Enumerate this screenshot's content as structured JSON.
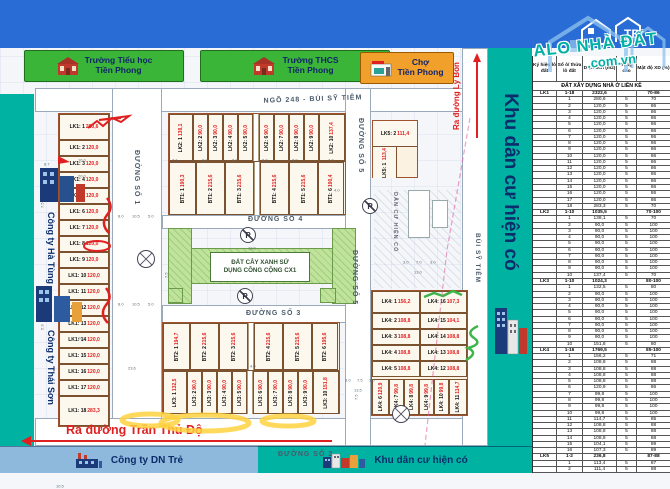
{
  "title": "KHU DÂN CƯ PHỐ BÙI SỸ TIÊM",
  "distributor": {
    "label": "ĐƠN VỊ PHÂN PHỐI",
    "logo_text": "THAI BINH LAND"
  },
  "watermark": {
    "line1": "ALO NHÀ ĐẤT",
    "line2": ".com.vn"
  },
  "colors": {
    "header_blue": "#2a6cd5",
    "teal": "#00b2a2",
    "lot_value_red": "#e02020",
    "green_area": "#bfe39b",
    "landmark_green": "#3bb537",
    "landmark_orange": "#f2a02c",
    "annotation_yellow": "#ffd23f"
  },
  "landmarks": {
    "school1_line1": "Trường Tiểu học",
    "school1_line2": "Tiền Phong",
    "school2_line1": "Trường THCS",
    "school2_line2": "Tiền Phong",
    "market_line1": "Chợ",
    "market_line2": "Tiền Phong"
  },
  "companies": {
    "c1": "Công ty Hà Tùng",
    "c2": "Công ty Thái Sơn",
    "c3": "Công ty DN Trẻ"
  },
  "sidebar": {
    "label": "Khu dân cư hiện có"
  },
  "bottom": {
    "teal_label": "Khu dân cư hiện có"
  },
  "exits": {
    "lybon": "Ra đường Lý Bôn",
    "tranthudo": "Ra đường Trần Thủ Độ"
  },
  "streets": {
    "ngo248": "NGÕ 248 - BÙI SỸ TIÊM",
    "d1": "ĐƯỜNG SỐ 1",
    "d2": "ĐƯỜNG SỐ 2",
    "d3": "ĐƯỜNG SỐ 3",
    "d4": "ĐƯỜNG SỐ 4",
    "d5": "ĐƯỜNG SỐ 5",
    "bst": "BÙI SỸ TIÊM",
    "existing": "DÂN CƯ HIỆN CÓ"
  },
  "green": {
    "cx1_line1": "ĐẤT CÂY XANH SỬ",
    "cx1_line2": "DỤNG CÔNG CỘNG CX1",
    "parking": "P"
  },
  "map": {
    "lk1_lots": [
      {
        "c": "LK1: 1",
        "v": "280,6",
        "h": 26
      },
      {
        "c": "LK1: 2",
        "v": "120,0",
        "h": 16
      },
      {
        "c": "LK1: 3",
        "v": "120,0",
        "h": 16
      },
      {
        "c": "LK1: 4",
        "v": "120,0",
        "h": 16
      },
      {
        "c": "LK1: 5",
        "v": "120,0",
        "h": 16
      },
      {
        "c": "LK1: 6",
        "v": "120,0",
        "h": 16
      },
      {
        "c": "LK1: 7",
        "v": "120,0",
        "h": 16
      },
      {
        "c": "LK1: 8",
        "v": "120,0",
        "h": 16
      },
      {
        "c": "LK1: 9",
        "v": "120,0",
        "h": 16
      },
      {
        "c": "LK1: 10",
        "v": "120,0",
        "h": 16
      },
      {
        "c": "LK1: 11",
        "v": "120,0",
        "h": 16
      },
      {
        "c": "LK1: 12",
        "v": "120,0",
        "h": 16
      },
      {
        "c": "LK1: 13",
        "v": "120,0",
        "h": 16
      },
      {
        "c": "LK1: 14",
        "v": "120,0",
        "h": 16
      },
      {
        "c": "LK1: 15",
        "v": "120,0",
        "h": 16
      },
      {
        "c": "LK1: 16",
        "v": "120,0",
        "h": 16
      },
      {
        "c": "LK1: 17",
        "v": "120,0",
        "h": 16
      },
      {
        "c": "LK1: 18",
        "v": "283,3",
        "h": 30
      }
    ],
    "lk2_row": [
      {
        "c": "LK2: 1",
        "v": "138,1",
        "w": 24
      },
      {
        "c": "LK2: 2",
        "v": "90,0",
        "w": 15
      },
      {
        "c": "LK2: 3",
        "v": "90,0",
        "w": 15
      },
      {
        "c": "LK2: 4",
        "v": "90,0",
        "w": 15
      },
      {
        "c": "LK2: 5",
        "v": "90,0",
        "w": 15
      },
      {
        "gap": true,
        "w": 6
      },
      {
        "c": "LK2: 6",
        "v": "90,0",
        "w": 15
      },
      {
        "c": "LK2: 7",
        "v": "90,0",
        "w": 15
      },
      {
        "c": "LK2: 8",
        "v": "90,0",
        "w": 15
      },
      {
        "c": "LK2: 9",
        "v": "90,0",
        "w": 15
      },
      {
        "c": "LK2: 10",
        "v": "137,4",
        "w": 26
      }
    ],
    "bt1_row": [
      {
        "c": "BT1: 1",
        "v": "190,3",
        "w": 27
      },
      {
        "c": "BT1: 2",
        "v": "215,6",
        "w": 29
      },
      {
        "c": "BT1: 3",
        "v": "215,6",
        "w": 29
      },
      {
        "gap": true,
        "w": 6
      },
      {
        "c": "BT1: 4",
        "v": "215,6",
        "w": 29
      },
      {
        "c": "BT1: 5",
        "v": "215,6",
        "w": 29
      },
      {
        "c": "BT1: 6",
        "v": "190,4",
        "w": 26
      }
    ],
    "bt2_row": [
      {
        "c": "BT2: 1",
        "v": "194,7",
        "w": 27
      },
      {
        "c": "BT2: 2",
        "v": "215,6",
        "w": 29
      },
      {
        "c": "BT2: 3",
        "v": "215,6",
        "w": 29
      },
      {
        "gap": true,
        "w": 6
      },
      {
        "c": "BT2: 4",
        "v": "215,6",
        "w": 29
      },
      {
        "c": "BT2: 5",
        "v": "215,6",
        "w": 29
      },
      {
        "c": "BT2: 6",
        "v": "195,6",
        "w": 26
      }
    ],
    "lk3_row": [
      {
        "c": "LK3: 1",
        "v": "132,5",
        "w": 24
      },
      {
        "c": "LK3: 2",
        "v": "90,0",
        "w": 15
      },
      {
        "c": "LK3: 3",
        "v": "90,0",
        "w": 15
      },
      {
        "c": "LK3: 4",
        "v": "90,0",
        "w": 15
      },
      {
        "c": "LK3: 5",
        "v": "90,0",
        "w": 15
      },
      {
        "gap": true,
        "w": 6
      },
      {
        "c": "LK3: 6",
        "v": "90,0",
        "w": 15
      },
      {
        "c": "LK3: 7",
        "v": "90,0",
        "w": 15
      },
      {
        "c": "LK3: 8",
        "v": "90,0",
        "w": 15
      },
      {
        "c": "LK3: 9",
        "v": "90,0",
        "w": 15
      },
      {
        "c": "LK3: 10",
        "v": "151,8",
        "w": 26
      }
    ],
    "lk4_left": [
      {
        "c": "LK4: 1",
        "v": "156,2",
        "h": 22
      },
      {
        "c": "LK4: 2",
        "v": "108,8",
        "h": 16
      },
      {
        "c": "LK4: 3",
        "v": "108,8",
        "h": 16
      },
      {
        "c": "LK4: 4",
        "v": "108,8",
        "h": 16
      },
      {
        "c": "LK4: 5",
        "v": "108,8",
        "h": 16
      }
    ],
    "lk4_right": [
      {
        "c": "LK4: 16",
        "v": "107,3",
        "h": 22
      },
      {
        "c": "LK4: 15",
        "v": "104,1",
        "h": 16
      },
      {
        "c": "LK4: 14",
        "v": "108,8",
        "h": 16
      },
      {
        "c": "LK4: 13",
        "v": "108,8",
        "h": 16
      },
      {
        "c": "LK4: 12",
        "v": "108,8",
        "h": 16
      }
    ],
    "lk4_bottom": [
      {
        "c": "LK4: 6",
        "v": "120,9",
        "w": 17
      },
      {
        "c": "LK4: 7",
        "v": "99,8",
        "w": 15
      },
      {
        "c": "LK4: 8",
        "v": "99,8",
        "w": 15
      },
      {
        "c": "LK4: 9",
        "v": "99,8",
        "w": 15
      },
      {
        "c": "LK4: 10",
        "v": "99,8",
        "w": 15
      },
      {
        "c": "LK4: 11",
        "v": "114,7",
        "w": 18
      }
    ],
    "lk5_top": {
      "c": "LK5: 2",
      "v": "111,4"
    },
    "lk5_bottom": {
      "c": "LK5: 1",
      "v": "113,4"
    },
    "dimensions": [
      {
        "t": "8.7",
        "x": 44,
        "y": 114
      },
      {
        "t": "16.0",
        "x": 78,
        "y": 110
      },
      {
        "t": "20.0",
        "x": 78,
        "y": 126
      },
      {
        "t": "7.5",
        "x": 40,
        "y": 160,
        "r": 1
      },
      {
        "t": "5.3",
        "x": 40,
        "y": 282,
        "r": 1
      },
      {
        "t": "20.0",
        "x": 78,
        "y": 288
      },
      {
        "t": "16.0",
        "x": 76,
        "y": 418
      },
      {
        "t": "5.3",
        "x": 50,
        "y": 416
      },
      {
        "t": "8.0",
        "x": 118,
        "y": 166
      },
      {
        "t": "10.5",
        "x": 132,
        "y": 166
      },
      {
        "t": "5.0",
        "x": 148,
        "y": 166
      },
      {
        "t": "8.0",
        "x": 118,
        "y": 254
      },
      {
        "t": "10.5",
        "x": 132,
        "y": 254
      },
      {
        "t": "5.0",
        "x": 148,
        "y": 254
      },
      {
        "t": "23.6",
        "x": 128,
        "y": 318
      },
      {
        "t": "10.5",
        "x": 56,
        "y": 436
      },
      {
        "t": "7.1",
        "x": 172,
        "y": 110
      },
      {
        "t": "8.0",
        "x": 202,
        "y": 110
      },
      {
        "t": "8.0",
        "x": 232,
        "y": 110
      },
      {
        "t": "8.0",
        "x": 262,
        "y": 110
      },
      {
        "t": "8.0",
        "x": 292,
        "y": 110
      },
      {
        "t": "7.0",
        "x": 328,
        "y": 110
      },
      {
        "t": "4.0",
        "x": 334,
        "y": 140
      },
      {
        "t": "12.0",
        "x": 248,
        "y": 198
      },
      {
        "t": "4.0",
        "x": 250,
        "y": 316
      },
      {
        "t": "3.0",
        "x": 403,
        "y": 212
      },
      {
        "t": "7.0",
        "x": 416,
        "y": 212
      },
      {
        "t": "3.0",
        "x": 430,
        "y": 212
      },
      {
        "t": "13.0",
        "x": 414,
        "y": 222
      },
      {
        "t": "7.5",
        "x": 354,
        "y": 240,
        "r": 1
      },
      {
        "t": "7.5",
        "x": 354,
        "y": 352,
        "r": 1
      },
      {
        "t": "3.0",
        "x": 345,
        "y": 330
      },
      {
        "t": "7.5",
        "x": 357,
        "y": 330
      },
      {
        "t": "3.0",
        "x": 369,
        "y": 330
      },
      {
        "t": "13.5",
        "x": 354,
        "y": 340
      },
      {
        "t": "7.5",
        "x": 164,
        "y": 230,
        "r": 1
      }
    ]
  },
  "table": {
    "headers": [
      "Ký hiệu lô đất",
      "Số ô/ thửa lô đất",
      "Diện tích (m2)",
      "Tầng cao",
      "Mật độ XD (%)"
    ],
    "section": "ĐẤT XÂY DỰNG NHÀ Ở LIỀN KỀ",
    "groups": [
      {
        "code": "LK1",
        "range": "1-18",
        "total": "2322,6",
        "density": "70-86",
        "rows": [
          [
            "1",
            "280,6",
            "5",
            "70"
          ],
          [
            "2",
            "120,0",
            "5",
            "86"
          ],
          [
            "3",
            "120,0",
            "5",
            "86"
          ],
          [
            "4",
            "120,0",
            "5",
            "86"
          ],
          [
            "5",
            "120,0",
            "5",
            "86"
          ],
          [
            "6",
            "120,0",
            "5",
            "86"
          ],
          [
            "7",
            "120,0",
            "5",
            "86"
          ],
          [
            "8",
            "120,0",
            "5",
            "86"
          ],
          [
            "9",
            "120,0",
            "5",
            "86"
          ],
          [
            "10",
            "120,0",
            "5",
            "86"
          ],
          [
            "11",
            "120,0",
            "5",
            "86"
          ],
          [
            "12",
            "120,0",
            "5",
            "86"
          ],
          [
            "13",
            "120,0",
            "5",
            "86"
          ],
          [
            "14",
            "120,0",
            "5",
            "86"
          ],
          [
            "15",
            "120,0",
            "5",
            "86"
          ],
          [
            "16",
            "120,0",
            "5",
            "86"
          ],
          [
            "17",
            "120,0",
            "5",
            "86"
          ],
          [
            "18",
            "283,3",
            "5",
            "70"
          ]
        ]
      },
      {
        "code": "LK2",
        "range": "1-10",
        "total": "1035,5",
        "density": "70-100",
        "rows": [
          [
            "1",
            "138,1",
            "5",
            "70"
          ],
          [
            "2",
            "90,0",
            "5",
            "100"
          ],
          [
            "3",
            "90,0",
            "5",
            "100"
          ],
          [
            "4",
            "90,0",
            "5",
            "100"
          ],
          [
            "5",
            "90,0",
            "5",
            "100"
          ],
          [
            "6",
            "90,0",
            "5",
            "100"
          ],
          [
            "7",
            "90,0",
            "5",
            "100"
          ],
          [
            "8",
            "90,0",
            "5",
            "100"
          ],
          [
            "9",
            "90,0",
            "5",
            "100"
          ],
          [
            "10",
            "137,4",
            "5",
            "70"
          ]
        ]
      },
      {
        "code": "LK3",
        "range": "1-10",
        "total": "1024,3",
        "density": "80-100",
        "rows": [
          [
            "1",
            "132,5",
            "5",
            "80"
          ],
          [
            "2",
            "90,0",
            "5",
            "100"
          ],
          [
            "3",
            "90,0",
            "5",
            "100"
          ],
          [
            "4",
            "90,0",
            "5",
            "100"
          ],
          [
            "5",
            "90,0",
            "5",
            "100"
          ],
          [
            "6",
            "90,0",
            "5",
            "100"
          ],
          [
            "7",
            "90,0",
            "5",
            "100"
          ],
          [
            "8",
            "90,0",
            "5",
            "100"
          ],
          [
            "9",
            "90,0",
            "5",
            "100"
          ],
          [
            "10",
            "151,8",
            "5",
            "80"
          ]
        ]
      },
      {
        "code": "LK4",
        "range": "1-16",
        "total": "1769,5",
        "density": "85-100",
        "rows": [
          [
            "1",
            "156,2",
            "5",
            "71"
          ],
          [
            "2",
            "108,8",
            "5",
            "88"
          ],
          [
            "3",
            "108,8",
            "5",
            "88"
          ],
          [
            "4",
            "108,8",
            "5",
            "88"
          ],
          [
            "5",
            "108,8",
            "5",
            "88"
          ],
          [
            "6",
            "120,9",
            "5",
            "86"
          ],
          [
            "7",
            "99,8",
            "5",
            "100"
          ],
          [
            "8",
            "99,8",
            "5",
            "100"
          ],
          [
            "9",
            "99,8",
            "5",
            "100"
          ],
          [
            "10",
            "99,8",
            "5",
            "100"
          ],
          [
            "11",
            "114,7",
            "5",
            "85"
          ],
          [
            "12",
            "108,8",
            "5",
            "88"
          ],
          [
            "13",
            "108,8",
            "5",
            "88"
          ],
          [
            "14",
            "108,8",
            "5",
            "88"
          ],
          [
            "15",
            "104,1",
            "5",
            "89"
          ],
          [
            "16",
            "107,3",
            "5",
            "89"
          ]
        ]
      },
      {
        "code": "LK5",
        "range": "1-2",
        "total": "236,8",
        "density": "87-88",
        "rows": [
          [
            "1",
            "113,4",
            "5",
            "87"
          ],
          [
            "2",
            "111,4",
            "5",
            "88"
          ]
        ]
      }
    ]
  }
}
